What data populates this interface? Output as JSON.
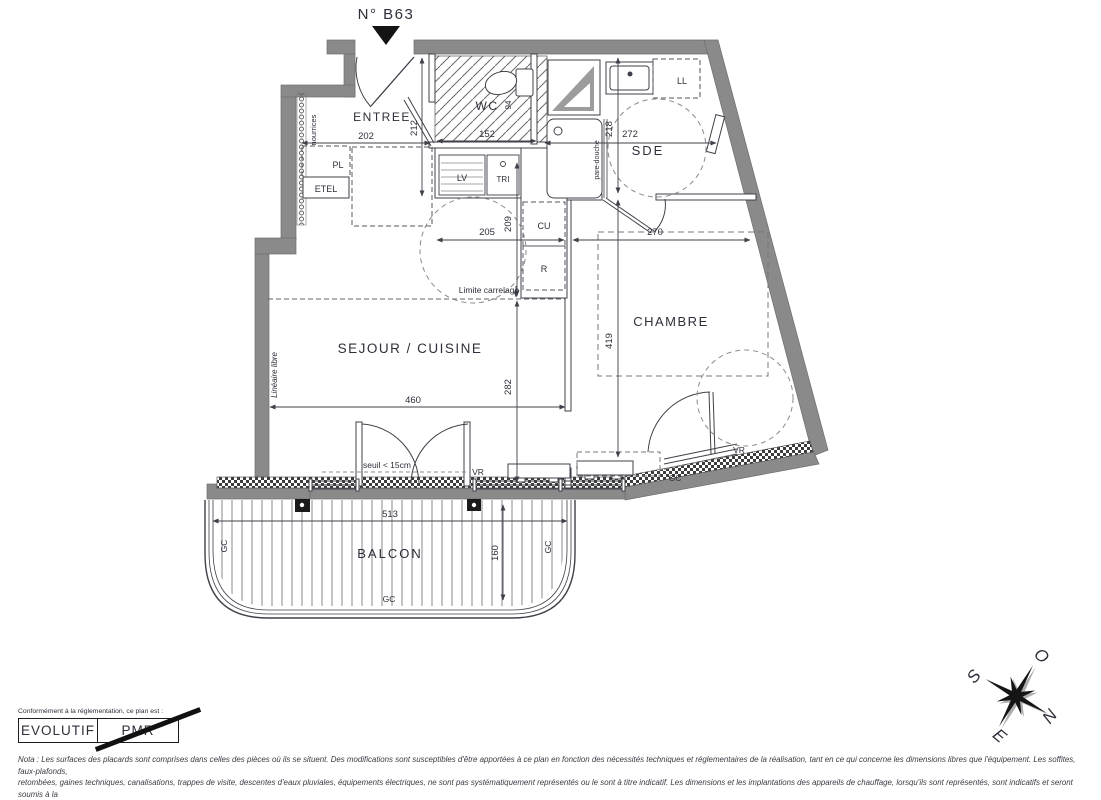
{
  "title": "N° B63",
  "colors": {
    "wall": "#8a8a8a",
    "line": "#3f4049",
    "text": "#2e2f3a",
    "accent_dark": "#111111"
  },
  "plan": {
    "rooms": {
      "entree": "ENTREE",
      "wc": "WC",
      "sde": "SDE",
      "sejour": "SEJOUR / CUISINE",
      "chambre": "CHAMBRE",
      "balcon": "BALCON"
    },
    "fixtures": {
      "pl": "PL",
      "etel": "ETEL",
      "lv": "LV",
      "tri": "TRI",
      "cu": "CU",
      "r": "R",
      "ll": "LL"
    },
    "dims": {
      "entree_w": "202",
      "entree_h": "212",
      "wc_w": "152",
      "wc_h": "94",
      "sde_w": "272",
      "sde_h": "218",
      "cuisine_w": "205",
      "carrelage_h": "209",
      "chambre_w": "270",
      "sejour_w": "460",
      "sejour_h": "282",
      "chambre_h": "419",
      "balcon_w": "513",
      "balcon_h": "160"
    },
    "annotations": {
      "limite_carrelage": "Limite carrelage",
      "seuil": "seuil < 15cm",
      "vr": "VR",
      "gc": "GC",
      "nourrices": "nourrices",
      "lineaire_libre": "Linéaire libre",
      "pare_douche": "pare-douche"
    }
  },
  "compass": {
    "n": "N",
    "s": "S",
    "e": "E",
    "o": "O"
  },
  "legend": {
    "intro": "Conformément à la réglementation, ce plan est :",
    "evolutif": "EVOLUTIF",
    "pmr": "PMR"
  },
  "nota": {
    "line1": "Nota : Les surfaces des placards sont comprises dans celles des pièces où ils se situent. Des modifications sont susceptibles d'être apportées à ce plan en fonction des nécessités techniques et réglementaires de la réalisation, tant en ce qui concerne les dimensions libres que l'équipement.  Les soffites, faux-plafonds,",
    "line2": "retombées, gaines techniques, canalisations, trappes de visite, descentes d'eaux pluviales, équipements électriques, ne sont pas systématiquement représentés ou le sont à titre indicatif. Les dimensions et les implantations des appareils de chauffage, lorsqu'ils sont représentés, sont indicatifs et seront soumis à la",
    "line3": "conformité de l'étude thermique. La forme des jardins( pente, talus...) n'est pas toujours représentée ou l'est à titre indicatif. La végétation éventuellement représentée n'est pas contractuelle. »"
  }
}
